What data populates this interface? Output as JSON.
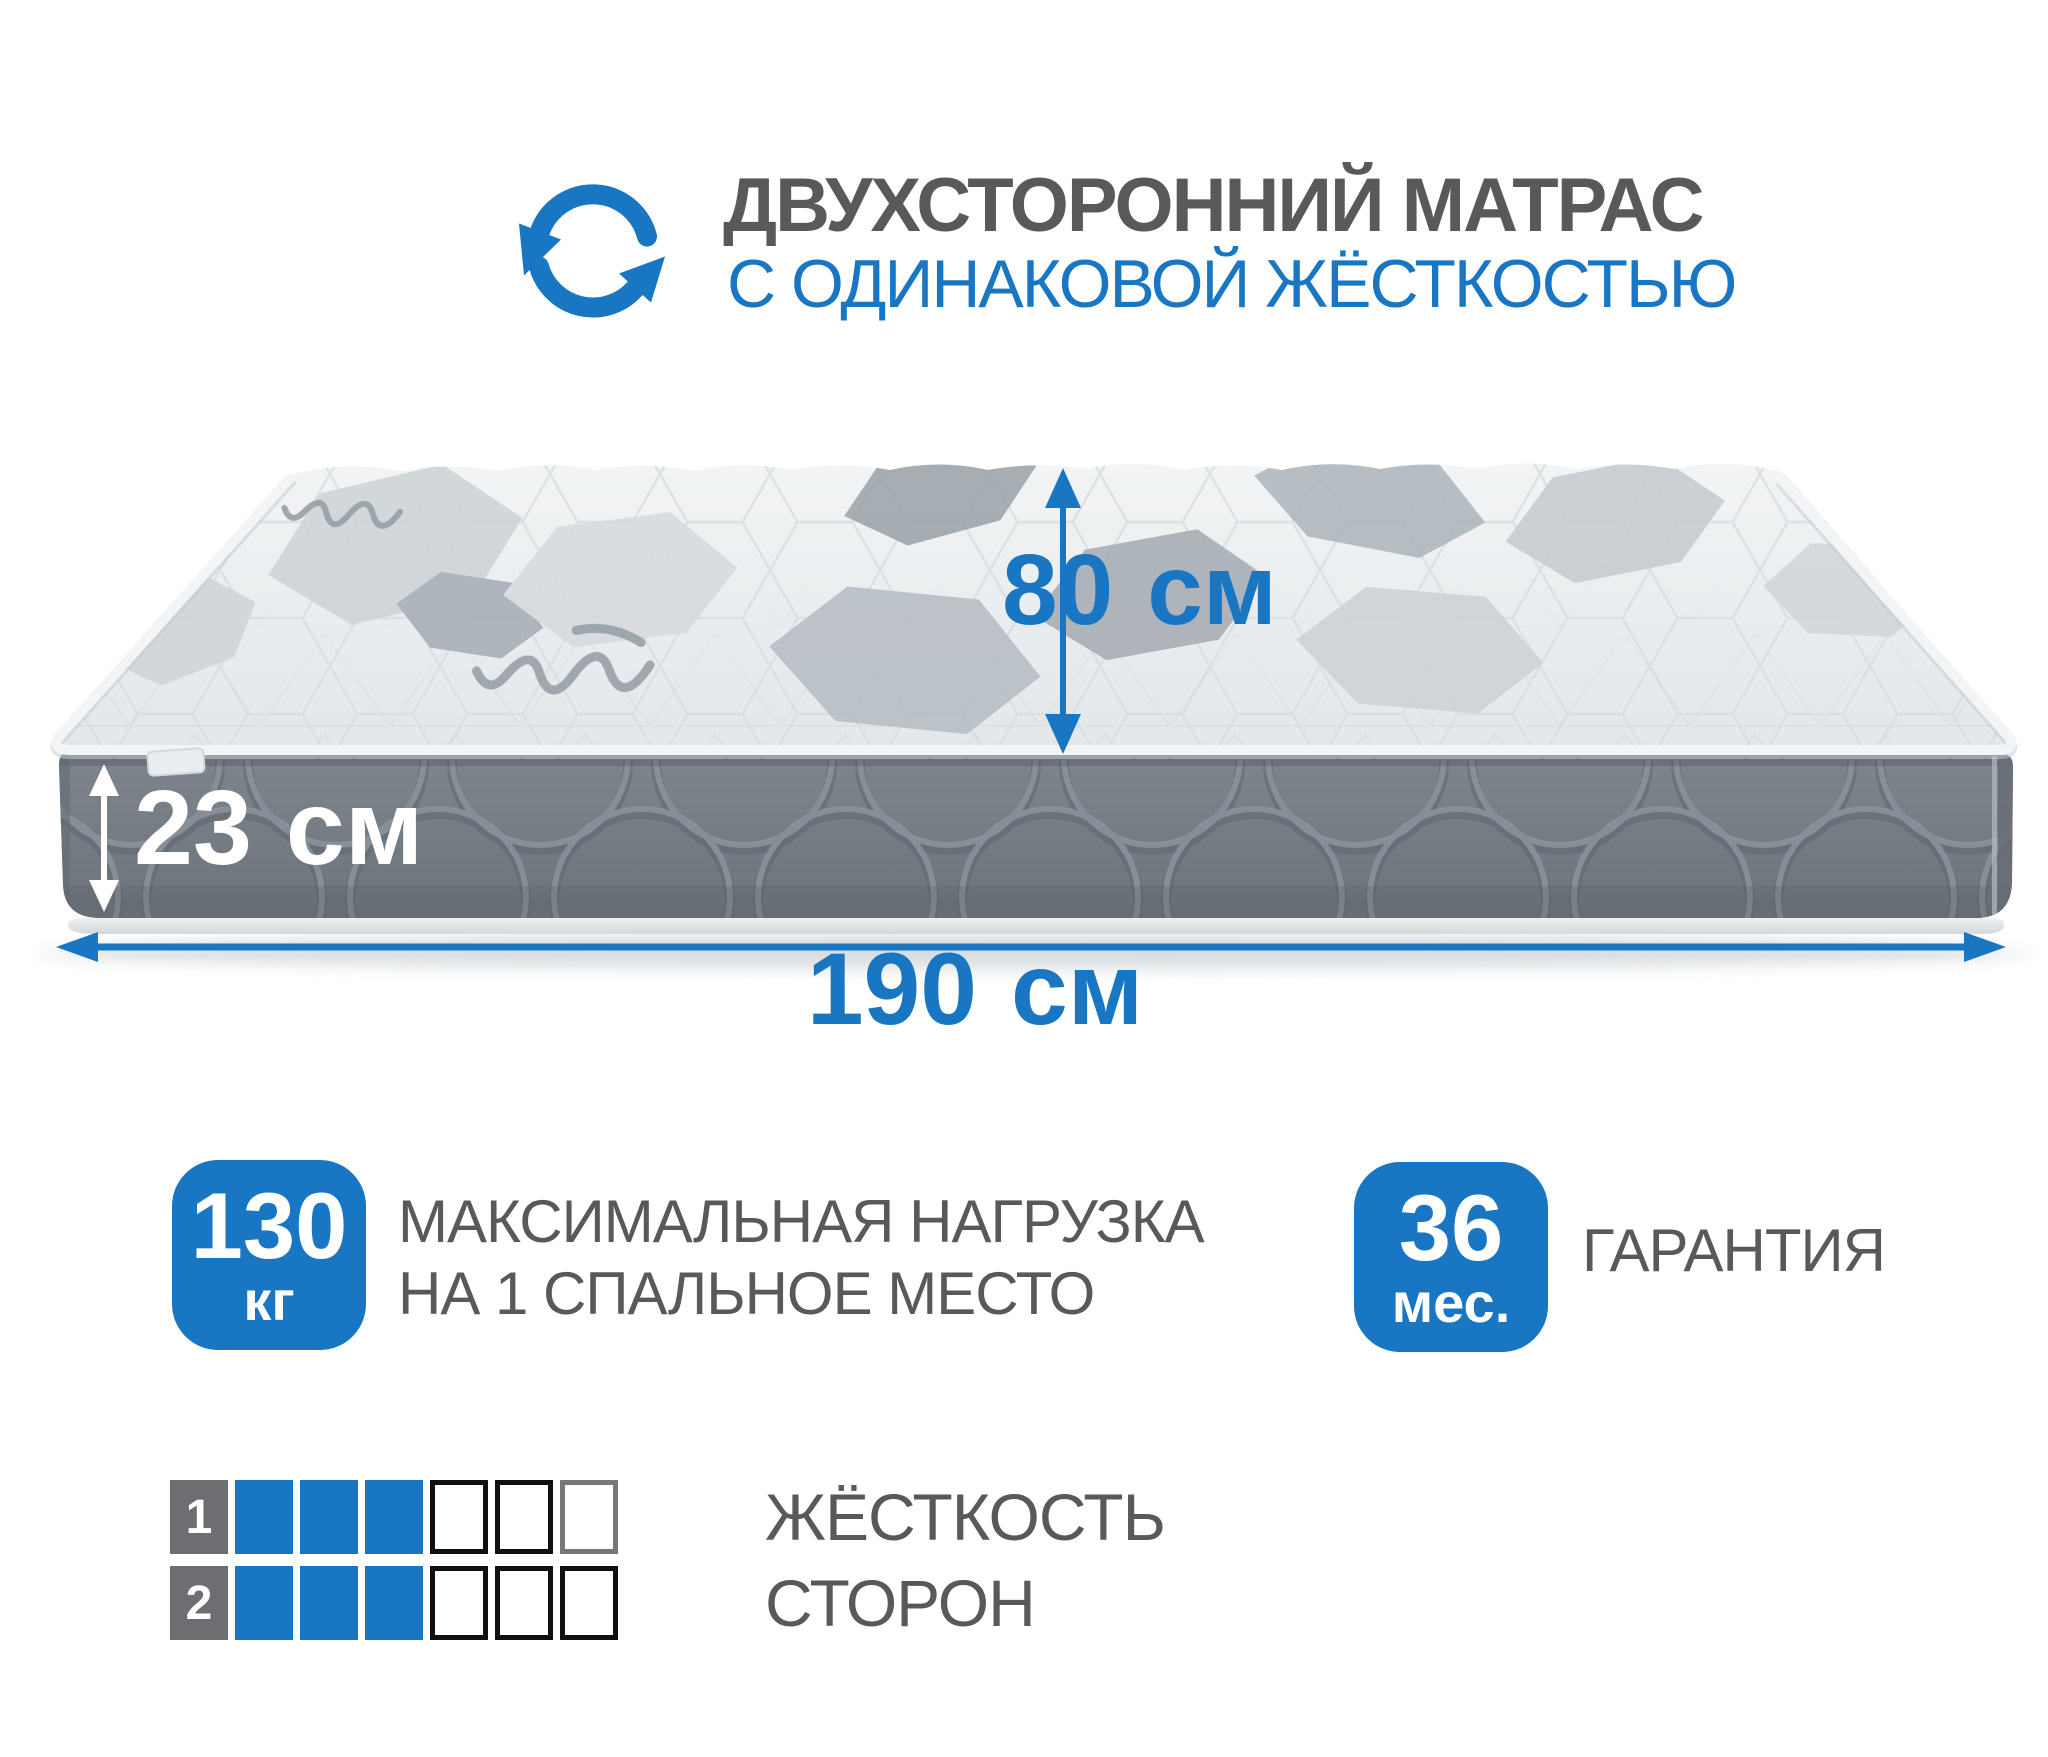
{
  "header": {
    "icon": "rotate-cycle-icon",
    "title_line1": "ДВУХСТОРОННИЙ МАТРАС",
    "title_line2": "С ОДИНАКОВОЙ ЖЁСТКОСТЬЮ"
  },
  "dimensions": {
    "sleep_width": {
      "value": "80",
      "unit": "см"
    },
    "height": {
      "value": "23",
      "unit": "см"
    },
    "length": {
      "value": "190",
      "unit": "см"
    }
  },
  "features": {
    "max_load": {
      "value": "130",
      "unit": "кг",
      "label_line1": "МАКСИМАЛЬНАЯ НАГРУЗКА",
      "label_line2": "НА 1 СПАЛЬНОЕ МЕСТО"
    },
    "warranty": {
      "value": "36",
      "unit": "мес.",
      "label": "ГАРАНТИЯ"
    }
  },
  "firmness": {
    "caption_line1": "ЖЁСТКОСТЬ",
    "caption_line2": "СТОРОН",
    "scale_max": 6,
    "rows": [
      {
        "label": "1",
        "filled": 3
      },
      {
        "label": "2",
        "filled": 3
      }
    ]
  },
  "colors": {
    "accent": "#1976c2",
    "text_gray": "#58595b",
    "mattress_side_gray": "#767d85",
    "scale_label_gray": "#6d6e71"
  }
}
